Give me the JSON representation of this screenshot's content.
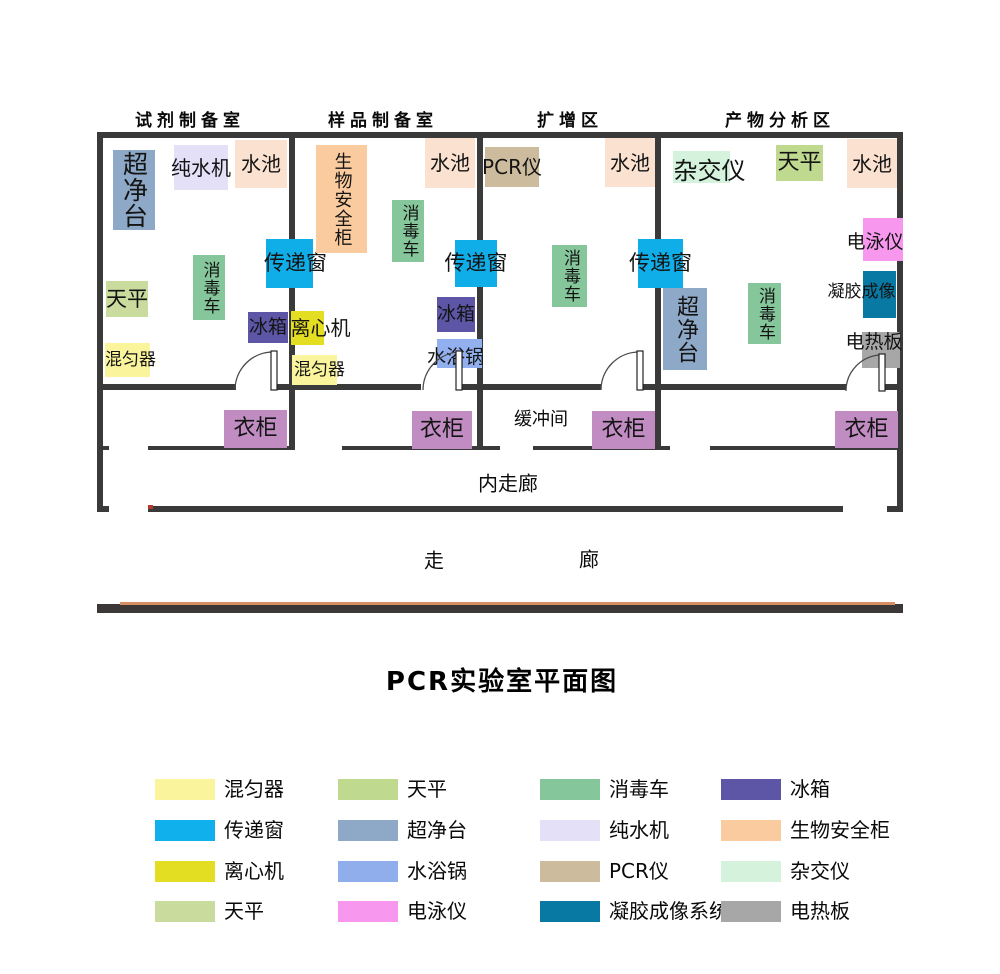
{
  "title": "PCR实验室平面图",
  "colors": {
    "wall": "#3A3A3A",
    "bottom_bar": "#3B3837",
    "bottom_bar_accent": "#D68E62",
    "door_arc": "#4A4A4A",
    "red_tick": "#B03A2E"
  },
  "rooms": [
    {
      "name": "reagent-prep",
      "label": "试剂制备室",
      "cx": 190
    },
    {
      "name": "sample-prep",
      "label": "样品制备室",
      "cx": 383
    },
    {
      "name": "amplification",
      "label": "扩增区",
      "cx": 570
    },
    {
      "name": "product-analysis",
      "label": "产物分析区",
      "cx": 780
    }
  ],
  "equipment": [
    {
      "name": "clean-bench-1",
      "label": "超净台",
      "color": "#8DA9C7",
      "x": 113,
      "y": 150,
      "w": 42,
      "h": 80,
      "vertical": true,
      "fs": 25
    },
    {
      "name": "water-purifier-1",
      "label": "纯水机",
      "color": "#E3E0F7",
      "x": 174,
      "y": 145,
      "w": 54,
      "h": 45,
      "fs": 20
    },
    {
      "name": "sink-1",
      "label": "水池",
      "color": "#FBE1D0",
      "x": 235,
      "y": 140,
      "w": 52,
      "h": 48,
      "fs": 20
    },
    {
      "name": "disinfect-cart-1",
      "label": "消毒车",
      "color": "#85C79B",
      "x": 193,
      "y": 255,
      "w": 32,
      "h": 65,
      "vertical": true,
      "fs": 17
    },
    {
      "name": "transfer-window-1",
      "label": "传递窗",
      "color": "#10AEE8",
      "x": 266,
      "y": 239,
      "w": 47,
      "h": 49,
      "fs": 21,
      "dx": 6
    },
    {
      "name": "balance-1",
      "label": "天平",
      "color": "#C9DC9E",
      "x": 106,
      "y": 281,
      "w": 42,
      "h": 36,
      "fs": 21
    },
    {
      "name": "fridge-1",
      "label": "冰箱",
      "color": "#5D56A6",
      "x": 248,
      "y": 312,
      "w": 40,
      "h": 31,
      "fs": 19
    },
    {
      "name": "mixer-1",
      "label": "混匀器",
      "color": "#FAF59D",
      "x": 105,
      "y": 343,
      "w": 45,
      "h": 34,
      "fs": 17,
      "dx": 3
    },
    {
      "name": "biosafety-cabinet",
      "label": "生物安全柜",
      "color": "#FACB9F",
      "x": 316,
      "y": 145,
      "w": 51,
      "h": 108,
      "vertical": true,
      "fs": 18
    },
    {
      "name": "sink-2",
      "label": "水池",
      "color": "#FBE1D0",
      "x": 425,
      "y": 138,
      "w": 50,
      "h": 50,
      "fs": 20
    },
    {
      "name": "disinfect-cart-2",
      "label": "消毒车",
      "color": "#85C79B",
      "x": 392,
      "y": 200,
      "w": 32,
      "h": 62,
      "vertical": true,
      "fs": 17
    },
    {
      "name": "transfer-window-2",
      "label": "传递窗",
      "color": "#10AEE8",
      "x": 455,
      "y": 240,
      "w": 42,
      "h": 47,
      "fs": 21
    },
    {
      "name": "fridge-2",
      "label": "冰箱",
      "color": "#5D56A6",
      "x": 437,
      "y": 297,
      "w": 38,
      "h": 35,
      "fs": 19
    },
    {
      "name": "water-bath",
      "label": "水浴锅",
      "color": "#92AFEF",
      "x": 437,
      "y": 339,
      "w": 45,
      "h": 29,
      "fs": 19,
      "dx": -4,
      "dy": 4
    },
    {
      "name": "centrifuge",
      "label": "离心机",
      "color": "#E3DE21",
      "x": 291,
      "y": 311,
      "w": 33,
      "h": 34,
      "fs": 20,
      "dx": 13
    },
    {
      "name": "mixer-2",
      "label": "混匀器",
      "color": "#FAF59D",
      "x": 292,
      "y": 355,
      "w": 45,
      "h": 30,
      "fs": 17,
      "dx": 5
    },
    {
      "name": "pcr-machine",
      "label": "PCR仪",
      "color": "#CCBC9D",
      "x": 485,
      "y": 147,
      "w": 54,
      "h": 40,
      "fs": 20
    },
    {
      "name": "sink-3",
      "label": "水池",
      "color": "#FBE1D0",
      "x": 605,
      "y": 138,
      "w": 50,
      "h": 49,
      "fs": 20
    },
    {
      "name": "disinfect-cart-3",
      "label": "消毒车",
      "color": "#85C79B",
      "x": 552,
      "y": 245,
      "w": 35,
      "h": 62,
      "vertical": true,
      "fs": 17
    },
    {
      "name": "transfer-window-3",
      "label": "传递窗",
      "color": "#10AEE8",
      "x": 638,
      "y": 239,
      "w": 45,
      "h": 49,
      "fs": 21
    },
    {
      "name": "hybridizer",
      "label": "杂交仪",
      "color": "#D5F3DC",
      "x": 673,
      "y": 151,
      "w": 57,
      "h": 32,
      "fs": 24,
      "dx": 8,
      "dy": 4
    },
    {
      "name": "balance-2",
      "label": "天平",
      "color": "#BFD98E",
      "x": 776,
      "y": 145,
      "w": 47,
      "h": 36,
      "fs": 22
    },
    {
      "name": "sink-4",
      "label": "水池",
      "color": "#FBE1D0",
      "x": 847,
      "y": 139,
      "w": 50,
      "h": 49,
      "fs": 20
    },
    {
      "name": "electrophoresis",
      "label": "电泳仪",
      "color": "#F797ED",
      "x": 863,
      "y": 218,
      "w": 40,
      "h": 43,
      "fs": 19,
      "dx": -8,
      "dy": 3
    },
    {
      "name": "gel-imaging",
      "label": "凝胶成像",
      "color": "#0879A3",
      "x": 863,
      "y": 271,
      "w": 33,
      "h": 47,
      "fs": 17,
      "dx": -18,
      "dy": -2
    },
    {
      "name": "hot-plate",
      "label": "电热板",
      "color": "#A7A7A7",
      "x": 862,
      "y": 332,
      "w": 38,
      "h": 36,
      "fs": 19,
      "dx": -7,
      "dy": -8
    },
    {
      "name": "clean-bench-2",
      "label": "超净台",
      "color": "#8DA9C7",
      "x": 663,
      "y": 288,
      "w": 44,
      "h": 82,
      "vertical": true,
      "fs": 22
    },
    {
      "name": "disinfect-cart-4",
      "label": "消毒车",
      "color": "#85C79B",
      "x": 748,
      "y": 283,
      "w": 33,
      "h": 61,
      "vertical": true,
      "fs": 17
    },
    {
      "name": "wardrobe-1",
      "label": "衣柜",
      "color": "#C18CC2",
      "x": 224,
      "y": 410,
      "w": 63,
      "h": 38,
      "fs": 22
    },
    {
      "name": "wardrobe-2",
      "label": "衣柜",
      "color": "#C18CC2",
      "x": 412,
      "y": 411,
      "w": 60,
      "h": 38,
      "fs": 22
    },
    {
      "name": "wardrobe-3",
      "label": "衣柜",
      "color": "#C18CC2",
      "x": 592,
      "y": 411,
      "w": 63,
      "h": 38,
      "fs": 22
    },
    {
      "name": "wardrobe-4",
      "label": "衣柜",
      "color": "#C18CC2",
      "x": 835,
      "y": 411,
      "w": 63,
      "h": 37,
      "fs": 22
    }
  ],
  "area_labels": [
    {
      "name": "buffer-room",
      "label": "缓冲间",
      "cx": 541,
      "cy": 418,
      "fs": 18
    },
    {
      "name": "inner-corridor",
      "label": "内走廊",
      "cx": 508,
      "cy": 482,
      "fs": 20
    },
    {
      "name": "corridor-zou",
      "label": "走",
      "cx": 434,
      "cy": 559,
      "fs": 20
    },
    {
      "name": "corridor-lang",
      "label": "廊",
      "cx": 589,
      "cy": 558,
      "fs": 20
    }
  ],
  "legend": [
    {
      "name": "mixer",
      "label": "混匀器",
      "color": "#FAF59D"
    },
    {
      "name": "balance-a",
      "label": "天平",
      "color": "#BFD98E"
    },
    {
      "name": "disinfect-cart",
      "label": "消毒车",
      "color": "#85C79B"
    },
    {
      "name": "fridge",
      "label": "冰箱",
      "color": "#5D56A6"
    },
    {
      "name": "transfer-window",
      "label": "传递窗",
      "color": "#10B0EC"
    },
    {
      "name": "clean-bench",
      "label": "超净台",
      "color": "#8DA9C7"
    },
    {
      "name": "water-purifier",
      "label": "纯水机",
      "color": "#E3E0F7"
    },
    {
      "name": "biosafety-cabinet",
      "label": "生物安全柜",
      "color": "#FACB9F"
    },
    {
      "name": "centrifuge",
      "label": "离心机",
      "color": "#E3DE21"
    },
    {
      "name": "water-bath",
      "label": "水浴锅",
      "color": "#91AEEC"
    },
    {
      "name": "pcr-machine",
      "label": "PCR仪",
      "color": "#CCBC9D"
    },
    {
      "name": "hybridizer",
      "label": "杂交仪",
      "color": "#D5F3DC"
    },
    {
      "name": "balance-b",
      "label": "天平",
      "color": "#C9DC9E"
    },
    {
      "name": "electrophoresis",
      "label": "电泳仪",
      "color": "#F797ED"
    },
    {
      "name": "gel-imaging-system",
      "label": "凝胶成像系统",
      "color": "#0879A3"
    },
    {
      "name": "hot-plate",
      "label": "电热板",
      "color": "#A7A7A7"
    }
  ]
}
